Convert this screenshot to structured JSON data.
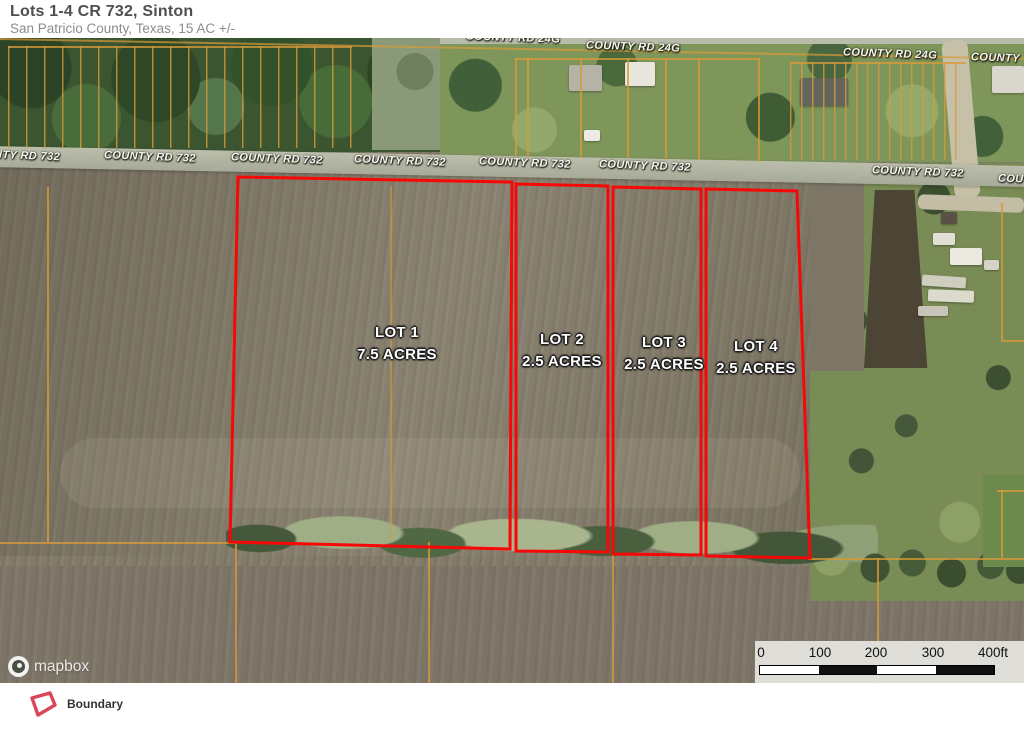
{
  "header": {
    "title": "Lots 1-4 CR 732, Sinton",
    "subtitle": "San Patricio County, Texas, 15 AC +/-"
  },
  "map": {
    "road_labels_732": [
      {
        "text": "NTY RD 732",
        "x": -6,
        "y": 112
      },
      {
        "text": "COUNTY RD 732",
        "x": 104,
        "y": 113
      },
      {
        "text": "COUNTY RD 732",
        "x": 231,
        "y": 115
      },
      {
        "text": "COUNTY RD 732",
        "x": 354,
        "y": 117
      },
      {
        "text": "COUNTY RD 732",
        "x": 479,
        "y": 119
      },
      {
        "text": "COUNTY RD 732",
        "x": 599,
        "y": 122
      },
      {
        "text": "COUNTY RD 732",
        "x": 872,
        "y": 128
      },
      {
        "text": "COU",
        "x": 998,
        "y": 135
      }
    ],
    "road_labels_24g": [
      {
        "text": "COUNTY RD 24G",
        "x": 466,
        "y": -6
      },
      {
        "text": "COUNTY RD 24G",
        "x": 586,
        "y": 3
      },
      {
        "text": "COUNTY RD 24G",
        "x": 843,
        "y": 10
      },
      {
        "text": "COUNTY",
        "x": 971,
        "y": 14
      }
    ],
    "lots": [
      {
        "name": "LOT 1",
        "acres": "7.5 ACRES",
        "polygon": "238,139 512,144 510,511 230,504",
        "label_x": 397,
        "label_y": 284
      },
      {
        "name": "LOT 2",
        "acres": "2.5 ACRES",
        "polygon": "516,146 608,148 608,514 516,513",
        "label_x": 562,
        "label_y": 291
      },
      {
        "name": "LOT 3",
        "acres": "2.5 ACRES",
        "polygon": "613,149 701,151 701,517 613,516",
        "label_x": 664,
        "label_y": 294
      },
      {
        "name": "LOT 4",
        "acres": "2.5 ACRES",
        "polygon": "706,151 797,153 810,520 706,518",
        "label_x": 756,
        "label_y": 298
      }
    ],
    "attribution": "mapbox"
  },
  "scale_bar": {
    "ticks": [
      {
        "label": "0",
        "x": 6
      },
      {
        "label": "100",
        "x": 65
      },
      {
        "label": "200",
        "x": 121
      },
      {
        "label": "300",
        "x": 178
      },
      {
        "label": "400ft",
        "x": 238
      }
    ],
    "segment_colors": [
      "#ffffff",
      "#101010",
      "#ffffff",
      "#101010"
    ],
    "segment_width": 58.5
  },
  "legend": {
    "items": [
      {
        "label": "Boundary"
      }
    ]
  },
  "colors": {
    "boundary_red": "#f80707",
    "parcel_orange": "#d79a38",
    "legend_red": "#d9455a"
  }
}
